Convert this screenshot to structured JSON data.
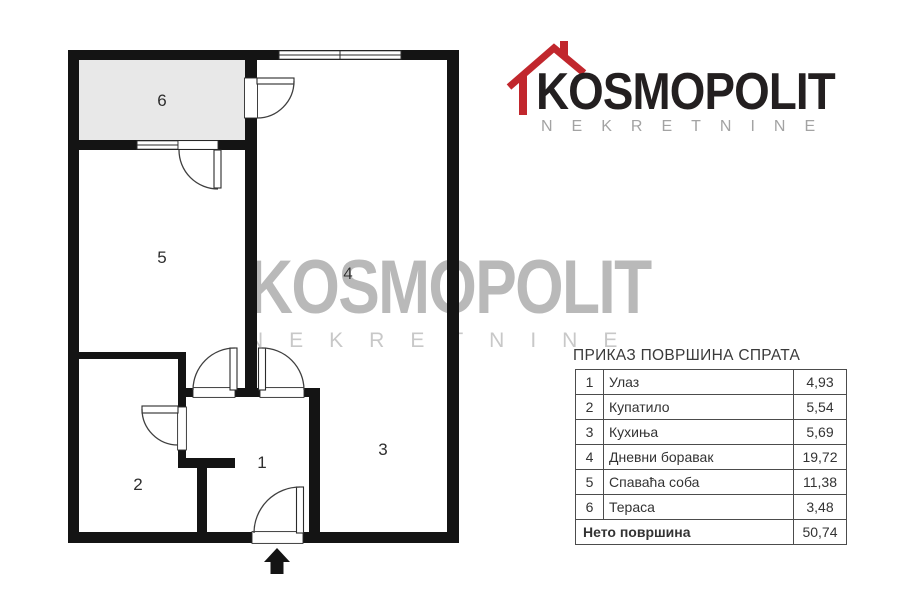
{
  "logo": {
    "brand": "KOSMOPOLIT",
    "tagline": "NEKRETNINE"
  },
  "watermark": {
    "line1": "KOSMOPOLIT",
    "line2": "NEKRETNINE"
  },
  "plan": {
    "labels": [
      "1",
      "2",
      "3",
      "4",
      "5",
      "6"
    ]
  },
  "area_table": {
    "title": "ПРИКАЗ ПОВРШИНА СПРАТА",
    "rows": [
      {
        "num": "1",
        "name": "Улаз",
        "area": "4,93"
      },
      {
        "num": "2",
        "name": "Купатило",
        "area": "5,54"
      },
      {
        "num": "3",
        "name": "Кухиња",
        "area": "5,69"
      },
      {
        "num": "4",
        "name": "Дневни боравак",
        "area": "19,72"
      },
      {
        "num": "5",
        "name": "Спаваћа соба",
        "area": "11,38"
      },
      {
        "num": "6",
        "name": "Тераса",
        "area": "3,48"
      }
    ],
    "footer": {
      "label": "Нето површина",
      "value": "50,74"
    }
  },
  "colors": {
    "brand_red": "#c1272d",
    "wall_black": "#141414",
    "terrace_fill": "#e8e8e8",
    "watermark_gray": "#b9b9b9"
  }
}
